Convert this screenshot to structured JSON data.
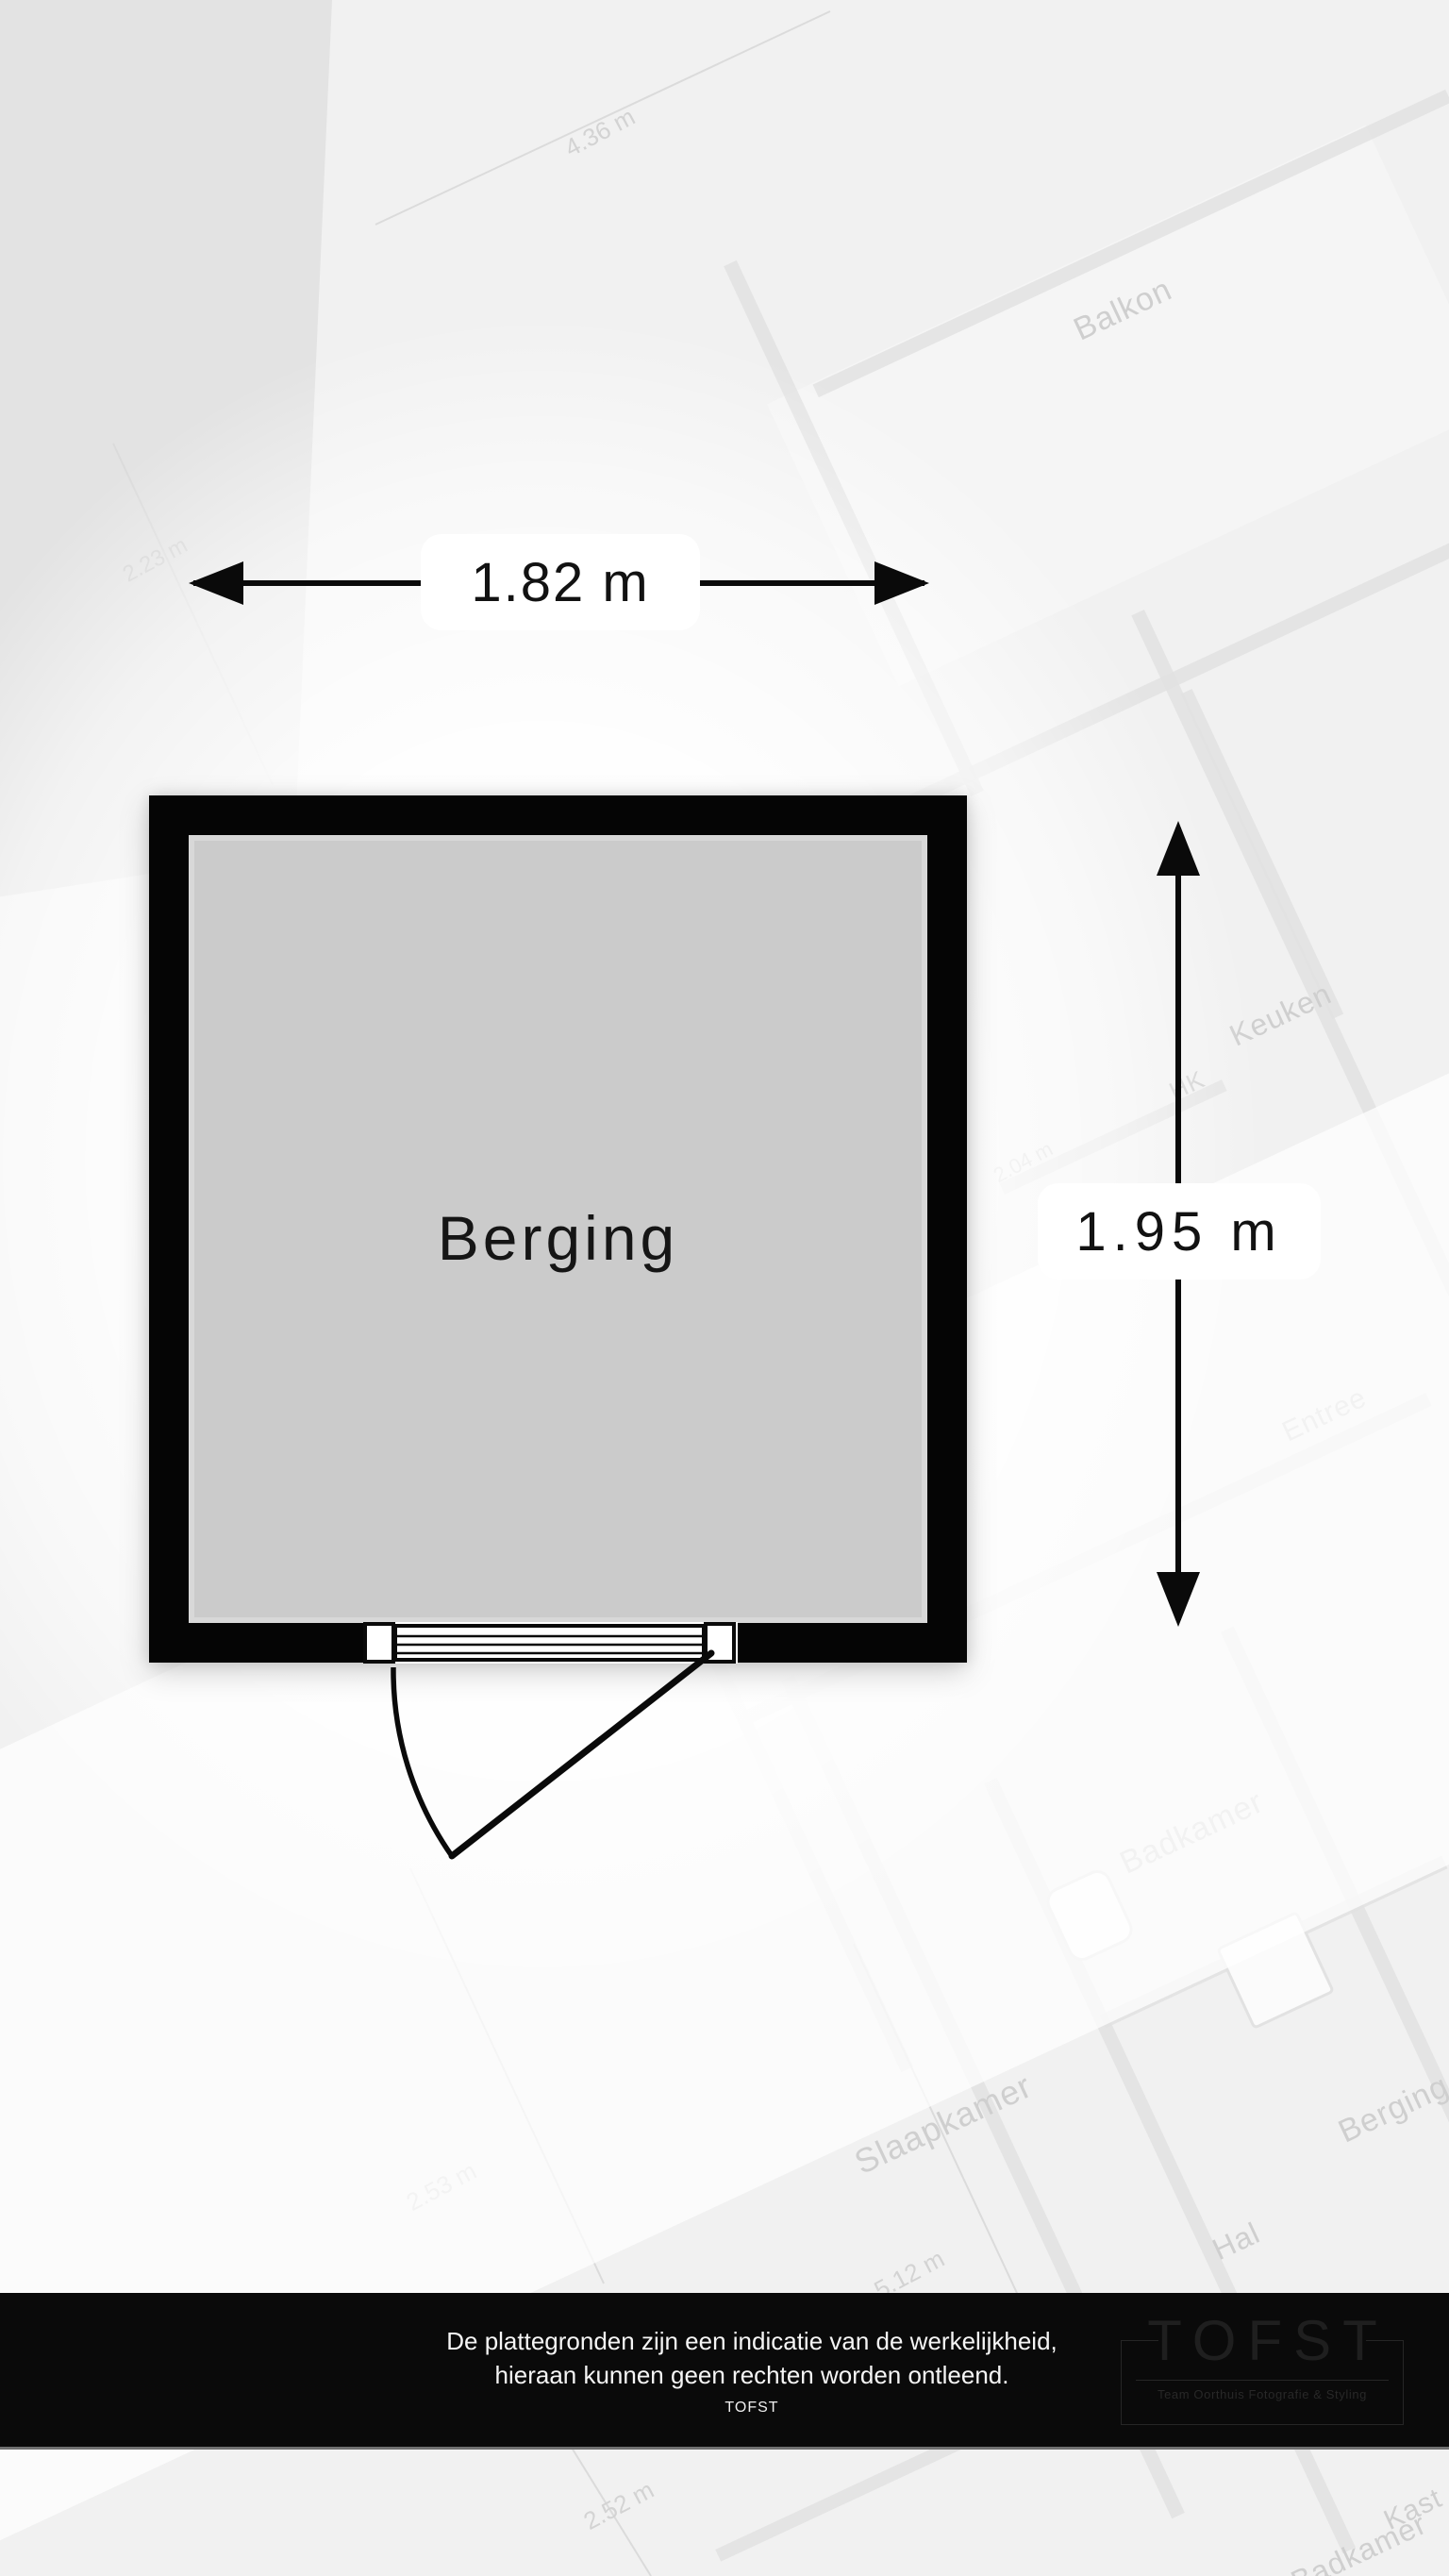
{
  "plan": {
    "room_label": "Berging",
    "width_dimension": "1.82 m",
    "height_dimension": "1.95 m"
  },
  "footer": {
    "disclaimer_line1": "De plattegronden zijn een indicatie van de werkelijkheid,",
    "disclaimer_line2": "hieraan kunnen geen rechten worden ontleend.",
    "brand": "TOFST",
    "logo_title": "TOFST",
    "logo_subtitle": "Team Oorthuis Fotografie & Styling"
  },
  "watermark": {
    "room_labels": [
      "Balkon",
      "Keuken",
      "HK",
      "Entree",
      "Slaapkamer",
      "Hal",
      "Badkamer",
      "Berging",
      "Kast",
      "Badkamer"
    ],
    "dimension_labels": [
      "4.36 m",
      "2.23 m",
      "2.04 m",
      "2.53 m",
      "5.12 m",
      "2.52 m"
    ]
  },
  "colors": {
    "wall": "#050505",
    "room_fill": "#cbcbcb",
    "room_inner_rim": "#d8d8d8",
    "background": "#f1f1f1",
    "background_wedge": "#e3e3e3",
    "watermark_ink": "#cfcfcf",
    "footer_background": "#0a0a0a",
    "footer_text": "#f5f5f5",
    "logo_ink": "#1f1f1f"
  }
}
